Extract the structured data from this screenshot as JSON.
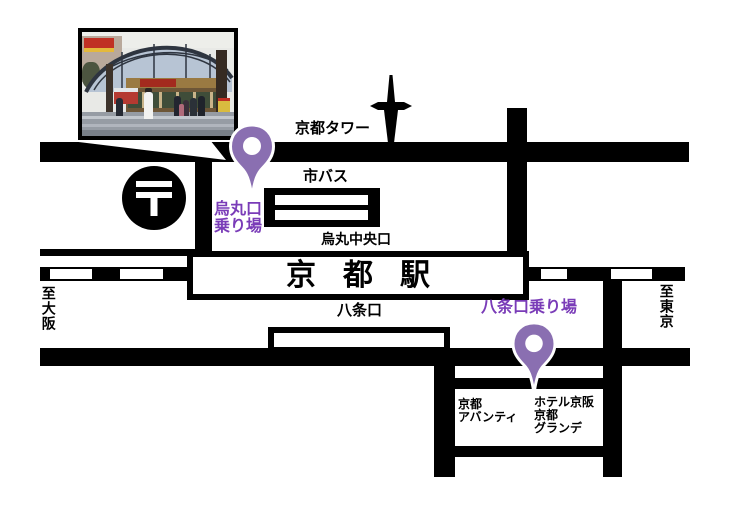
{
  "colors": {
    "road_black": "#000000",
    "pin_purple": "#8a6fb1",
    "label_purple": "#7a3cb8"
  },
  "map": {
    "station_label": "京都駅",
    "landmarks": {
      "kyoto_tower": "京都タワー",
      "city_bus": "市バス",
      "post_mark": "〒"
    },
    "exits": {
      "karasuma_central": "烏丸中央口",
      "hachijo": "八条口"
    },
    "bus_stops": {
      "karasuma": {
        "line1": "烏丸口",
        "line2": "乗り場"
      },
      "hachijo": {
        "label": "八条口乗り場"
      }
    },
    "directions": {
      "to_osaka": "至大阪",
      "to_tokyo": "至東京"
    },
    "buildings": {
      "avanti": {
        "line1": "京都",
        "line2": "アバンティ"
      },
      "hotel": {
        "line1": "ホテル京阪",
        "line2": "京都",
        "line3": "グランデ"
      }
    }
  }
}
